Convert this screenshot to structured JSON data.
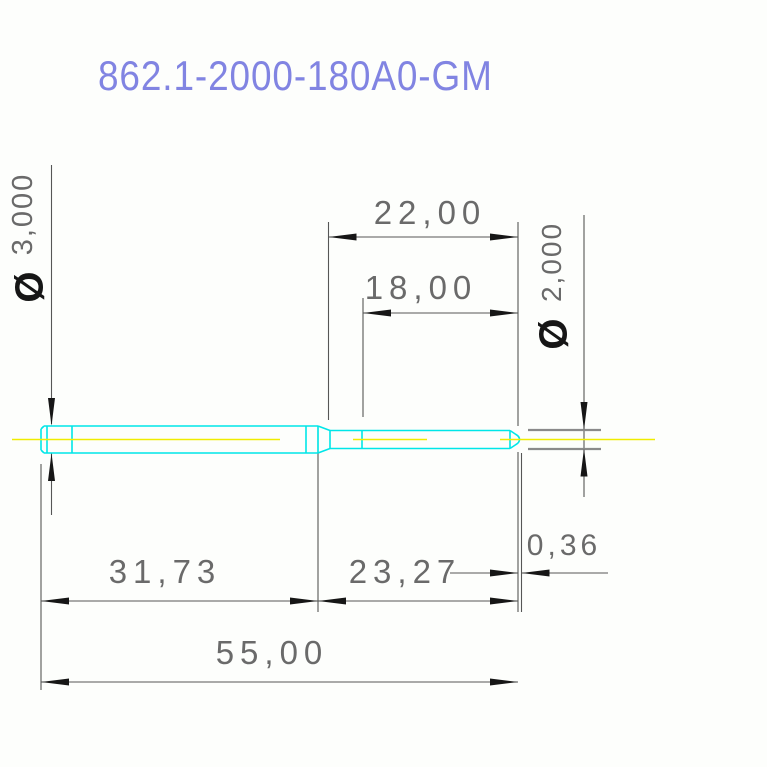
{
  "title": "862.1-2000-180A0-GM",
  "dimensions": {
    "length_22": "22,00",
    "length_18": "18,00",
    "length_31_73": "31,73",
    "length_23_27": "23,27",
    "length_0_36": "0,36",
    "length_55": "55,00",
    "diameter_3": {
      "symbol": "Ø",
      "value": "3,000"
    },
    "diameter_2": {
      "symbol": "Ø",
      "value": "2,000"
    }
  },
  "colors": {
    "title": "#8184e2",
    "dim-text": "#6a6a6a",
    "line": "#565656",
    "arrow": "#161616",
    "symbol": "#161616",
    "part": "#00e6e8",
    "centerline": "#f0ec00",
    "ext-bar": "#8a8a8a",
    "bg": "#fdfefc"
  }
}
